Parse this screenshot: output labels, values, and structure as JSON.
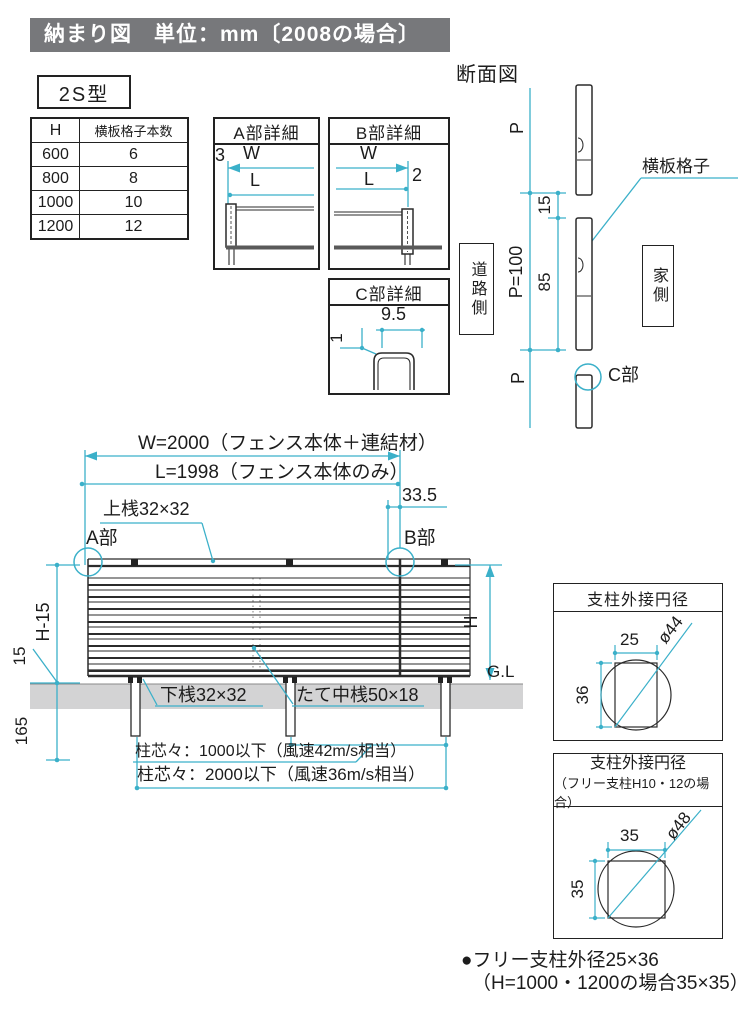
{
  "title": "納まり図　単位：mm〔2008の場合〕",
  "model_label": "2S型",
  "spec_table": {
    "headers": [
      "H",
      "横板格子本数"
    ],
    "rows": [
      [
        "600",
        "6"
      ],
      [
        "800",
        "8"
      ],
      [
        "1000",
        "10"
      ],
      [
        "1200",
        "12"
      ]
    ]
  },
  "detail_a": {
    "title": "A部詳細",
    "dim_3": "3",
    "dim_w": "W",
    "dim_l": "L"
  },
  "detail_b": {
    "title": "B部詳細",
    "dim_w": "W",
    "dim_l": "L",
    "dim_2": "2"
  },
  "detail_c": {
    "title": "C部詳細",
    "dim_95": "9.5",
    "dim_1": "1"
  },
  "section": {
    "title": "断面図",
    "dim_p_top": "P",
    "dim_15": "15",
    "dim_p100": "P=100",
    "dim_85": "85",
    "dim_p_bottom": "P",
    "label_board": "横板格子",
    "label_road": "道路側",
    "label_house": "家側",
    "label_c": "C部"
  },
  "elevation": {
    "dim_w": "W=2000（フェンス本体＋連結材）",
    "dim_l": "L=1998（フェンス本体のみ）",
    "dim_335": "33.5",
    "label_top_rail": "上桟32×32",
    "label_a": "A部",
    "label_b": "B部",
    "dim_h15": "H-15",
    "dim_15": "15",
    "dim_165": "165",
    "dim_h": "H",
    "label_gl": "G.L",
    "label_bottom_rail": "下桟32×32",
    "label_mid_rail": "たて中桟50×18",
    "note_post_1000": "柱芯々：1000以下（風速42m/s相当）",
    "note_post_2000": "柱芯々：2000以下（風速36m/s相当）"
  },
  "circum_box1": {
    "title": "支柱外接円径",
    "dim_w": "25",
    "dim_h": "36",
    "dim_d": "ø44"
  },
  "circum_box2": {
    "title": "支柱外接円径",
    "subtitle": "（フリー支柱H10・12の場合）",
    "dim_w": "35",
    "dim_h": "35",
    "dim_d": "ø48"
  },
  "footnote": {
    "line1": "●フリー支柱外径25×36",
    "line2": "（H=1000・1200の場合35×35）"
  },
  "colors": {
    "accent": "#3bb0c9",
    "title_bg": "#77787b",
    "ground": "#d3d3d4",
    "line": "#2b2b2b"
  }
}
